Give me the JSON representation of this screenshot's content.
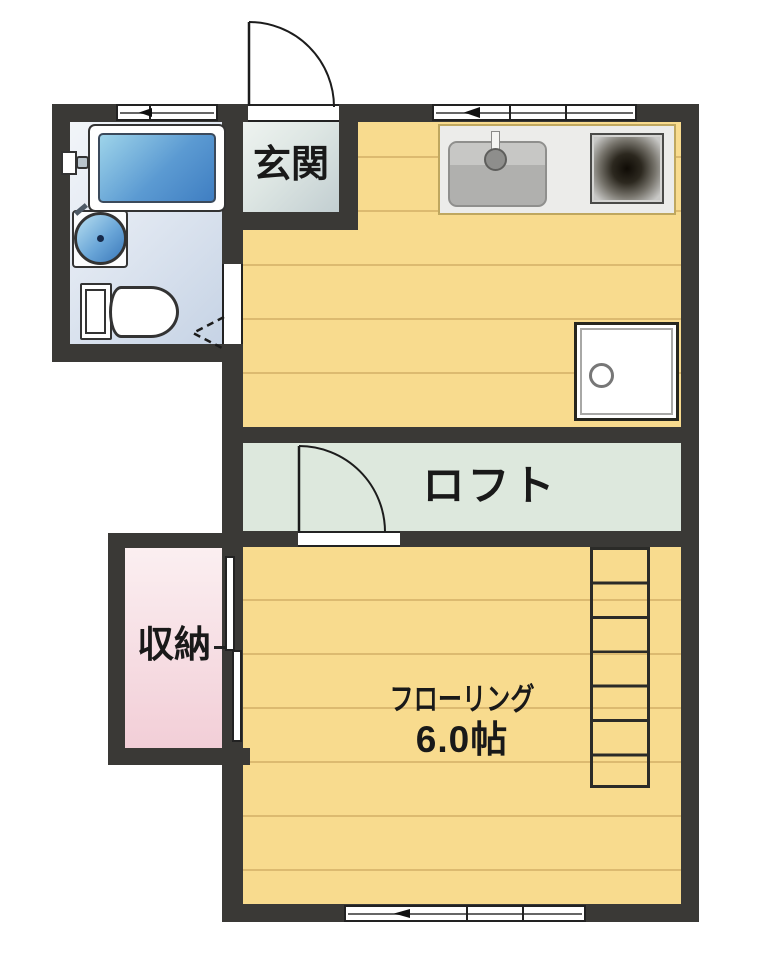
{
  "title": "apartment-floor-plan",
  "labels": {
    "entrance": "玄関",
    "loft": "ロフト",
    "closet": "収納",
    "flooring": "フローリング",
    "flooring_size": "6.0帖"
  },
  "fixtures": {
    "bathtub": "bathtub",
    "basin": "round-basin",
    "toilet": "toilet",
    "kitchen_sink": "kitchen-sink",
    "stove": "stove-burner",
    "washer": "washing-machine-pan",
    "ladder": "loft-ladder",
    "closet_door": "sliding-doors",
    "entrance_door": "hinged-door",
    "loft_door": "hinged-door",
    "bath_door": "folding-door"
  },
  "colors": {
    "wall": "#3a3936",
    "floor": "#f8db8e",
    "floor_line": "#dcba70",
    "loft_floor": "#dde8dd",
    "closet_floor": "#f2ced7",
    "bathroom_floor": "#d9e2ef",
    "entrance_floor": "#d3dcd9",
    "tub": "#4a86c4",
    "counter": "#ececea"
  }
}
